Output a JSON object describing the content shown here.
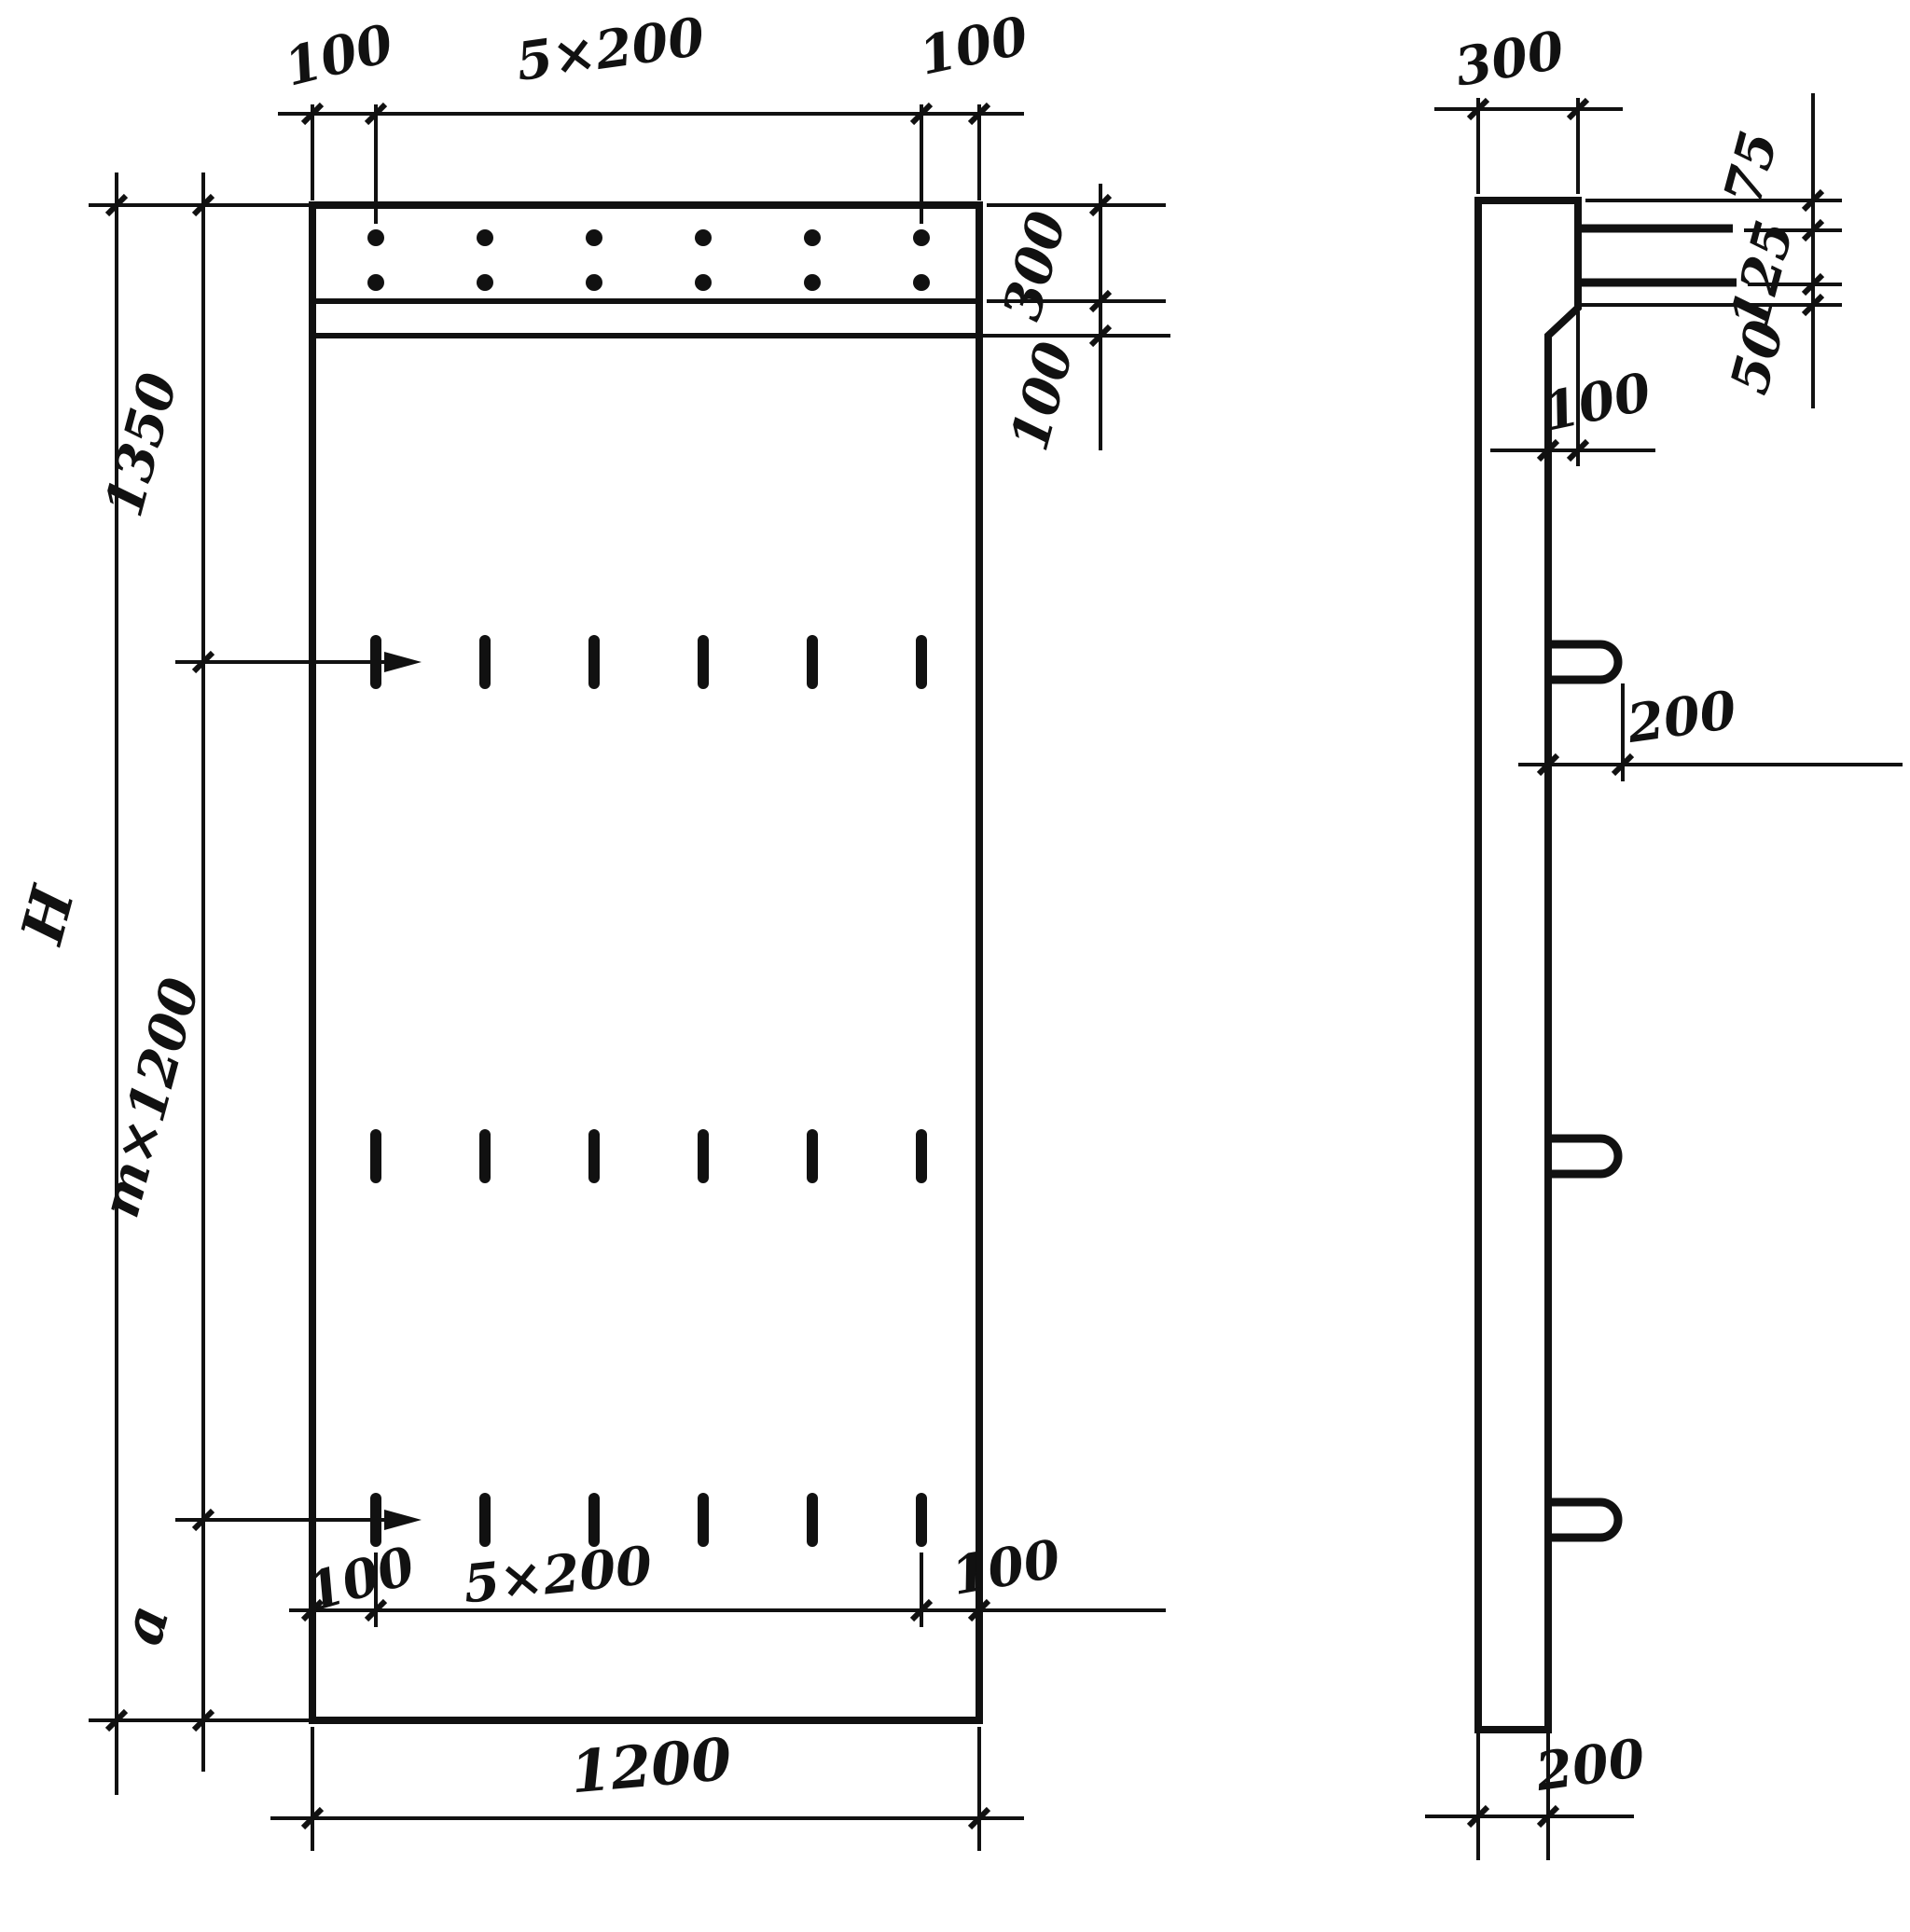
{
  "drawing": {
    "description": "Dimensioned two-view engineering drawing of a flat reinforced panel with protruding bars and lifting loops",
    "colors": {
      "ink": "#111111",
      "paper": "#ffffff"
    },
    "front_view": {
      "top_margin_left": "100",
      "top_spacing": "5×200",
      "top_margin_right": "100",
      "right_band_height": "300",
      "right_band_gap": "100",
      "left_top_offset": "1350",
      "left_overall_height": "H",
      "left_module_spacing": "m×1200",
      "left_bottom_offset": "a",
      "bottom_margin_left": "100",
      "bottom_spacing": "5×200",
      "bottom_margin_right": "100",
      "bottom_overall_width": "1200"
    },
    "side_view": {
      "top_thickness": "300",
      "bar_offset_top": "75",
      "bar_spacing": "125",
      "bar_offset_bottom": "50",
      "step_depth": "100",
      "loop_protrusion": "200",
      "bottom_thickness": "200"
    }
  }
}
